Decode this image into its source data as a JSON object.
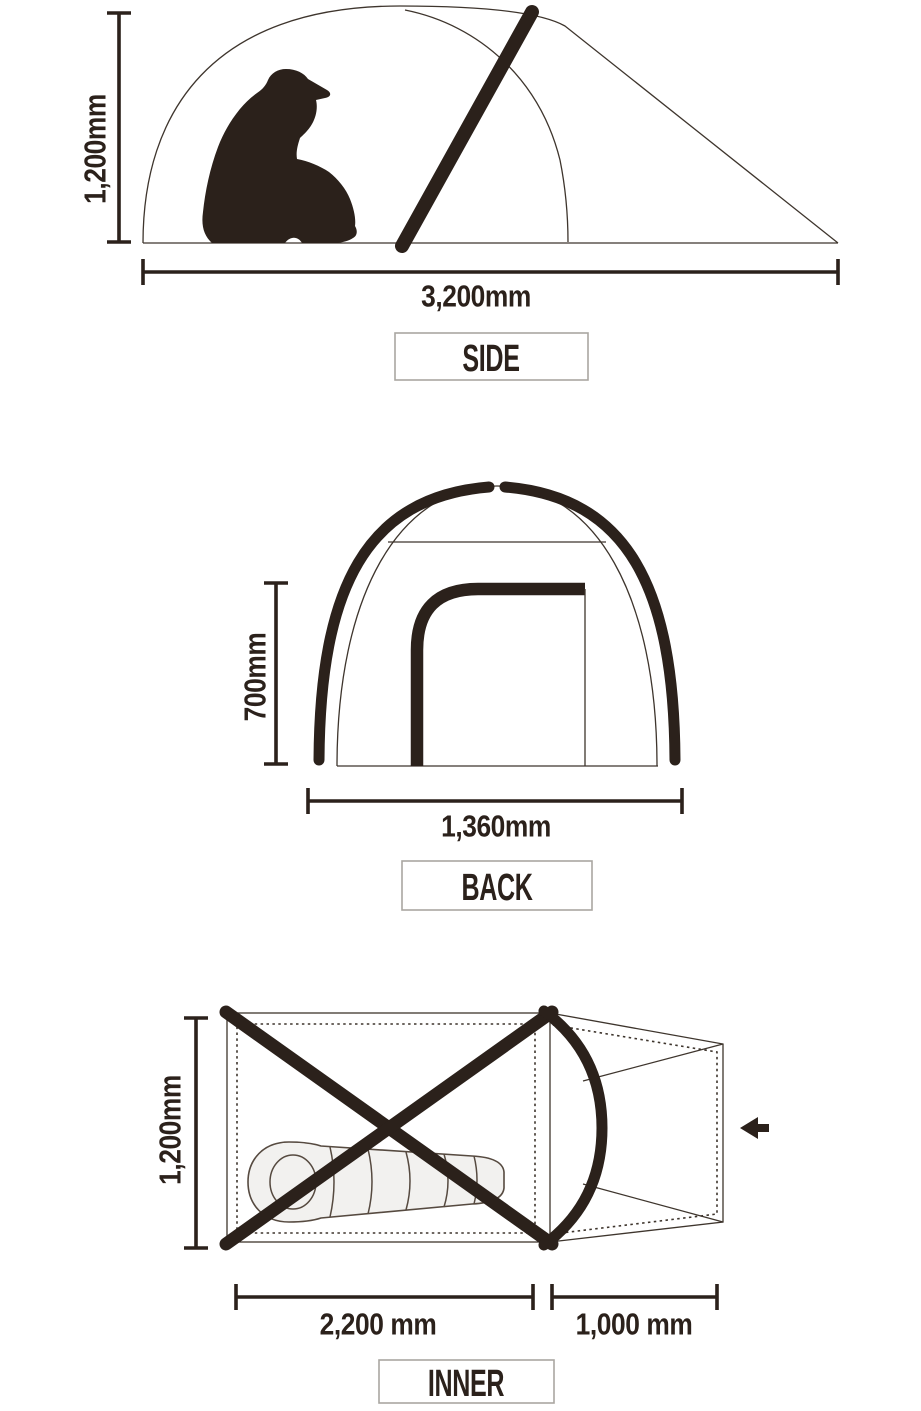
{
  "views": {
    "side": {
      "label": "SIDE",
      "height_dim": "1,200mm",
      "width_dim": "3,200mm"
    },
    "back": {
      "label": "BACK",
      "height_dim": "700mm",
      "width_dim": "1,360mm"
    },
    "inner": {
      "label": "INNER",
      "height_dim": "1,200mm",
      "length_dim": "2,200 mm",
      "vestibule_dim": "1,000 mm"
    }
  },
  "icons": {
    "person": "person-silhouette-icon",
    "sleeping_bag": "sleeping-bag-icon",
    "entrance_arrow": "left-arrow-icon"
  },
  "colors": {
    "ink": "#2b211b",
    "thin_line": "#3e352d",
    "box_border": "#aaa6a1",
    "bag_fill": "#f2f1ef",
    "bag_stroke": "#564a40",
    "background": "#ffffff"
  }
}
